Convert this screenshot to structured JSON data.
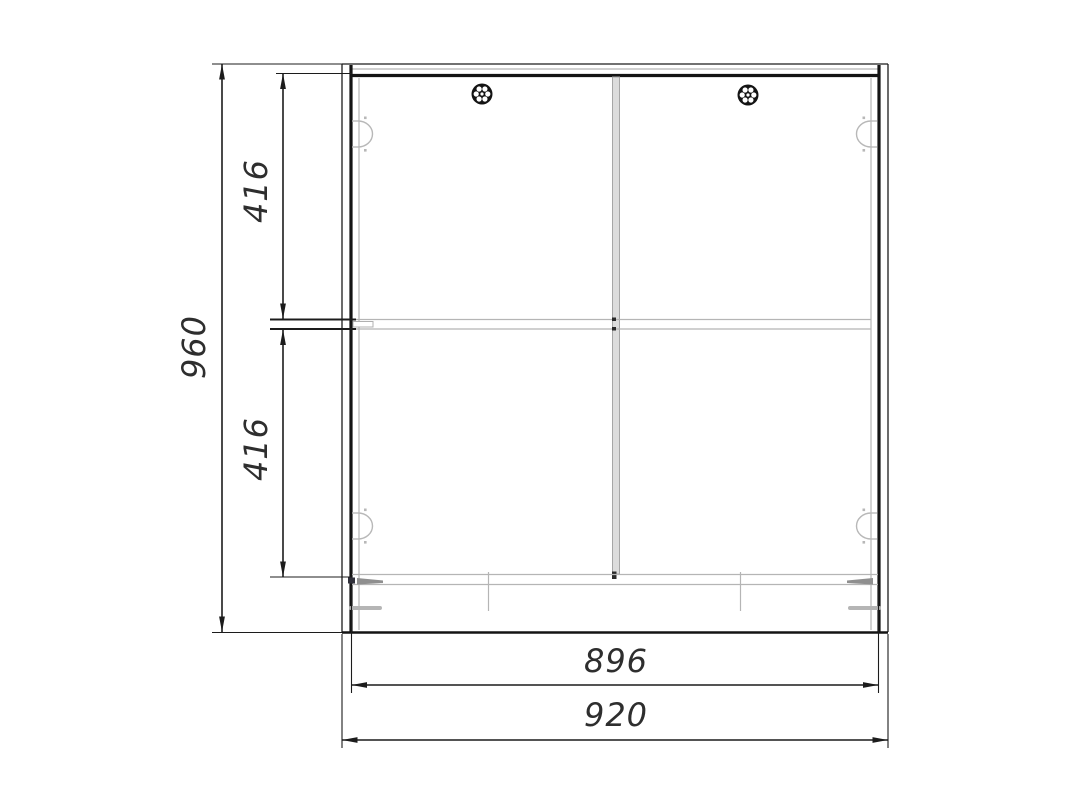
{
  "drawing": {
    "title": "cabinet-front-dimension-drawing",
    "dimensions": {
      "overall_height": "960",
      "upper_section_height": "416",
      "lower_section_height": "416",
      "inner_width": "896",
      "overall_width": "920"
    },
    "colors": {
      "line": "#1c1c1c",
      "light_detail": "#b5b5b5",
      "divider_fill": "#dcdcdc",
      "text": "#2e2e2e",
      "background": "#ffffff"
    },
    "icons": {
      "screw_head": "screw-head-rosette-icon",
      "cam_lock": "cam-lock-fitting-icon"
    }
  }
}
